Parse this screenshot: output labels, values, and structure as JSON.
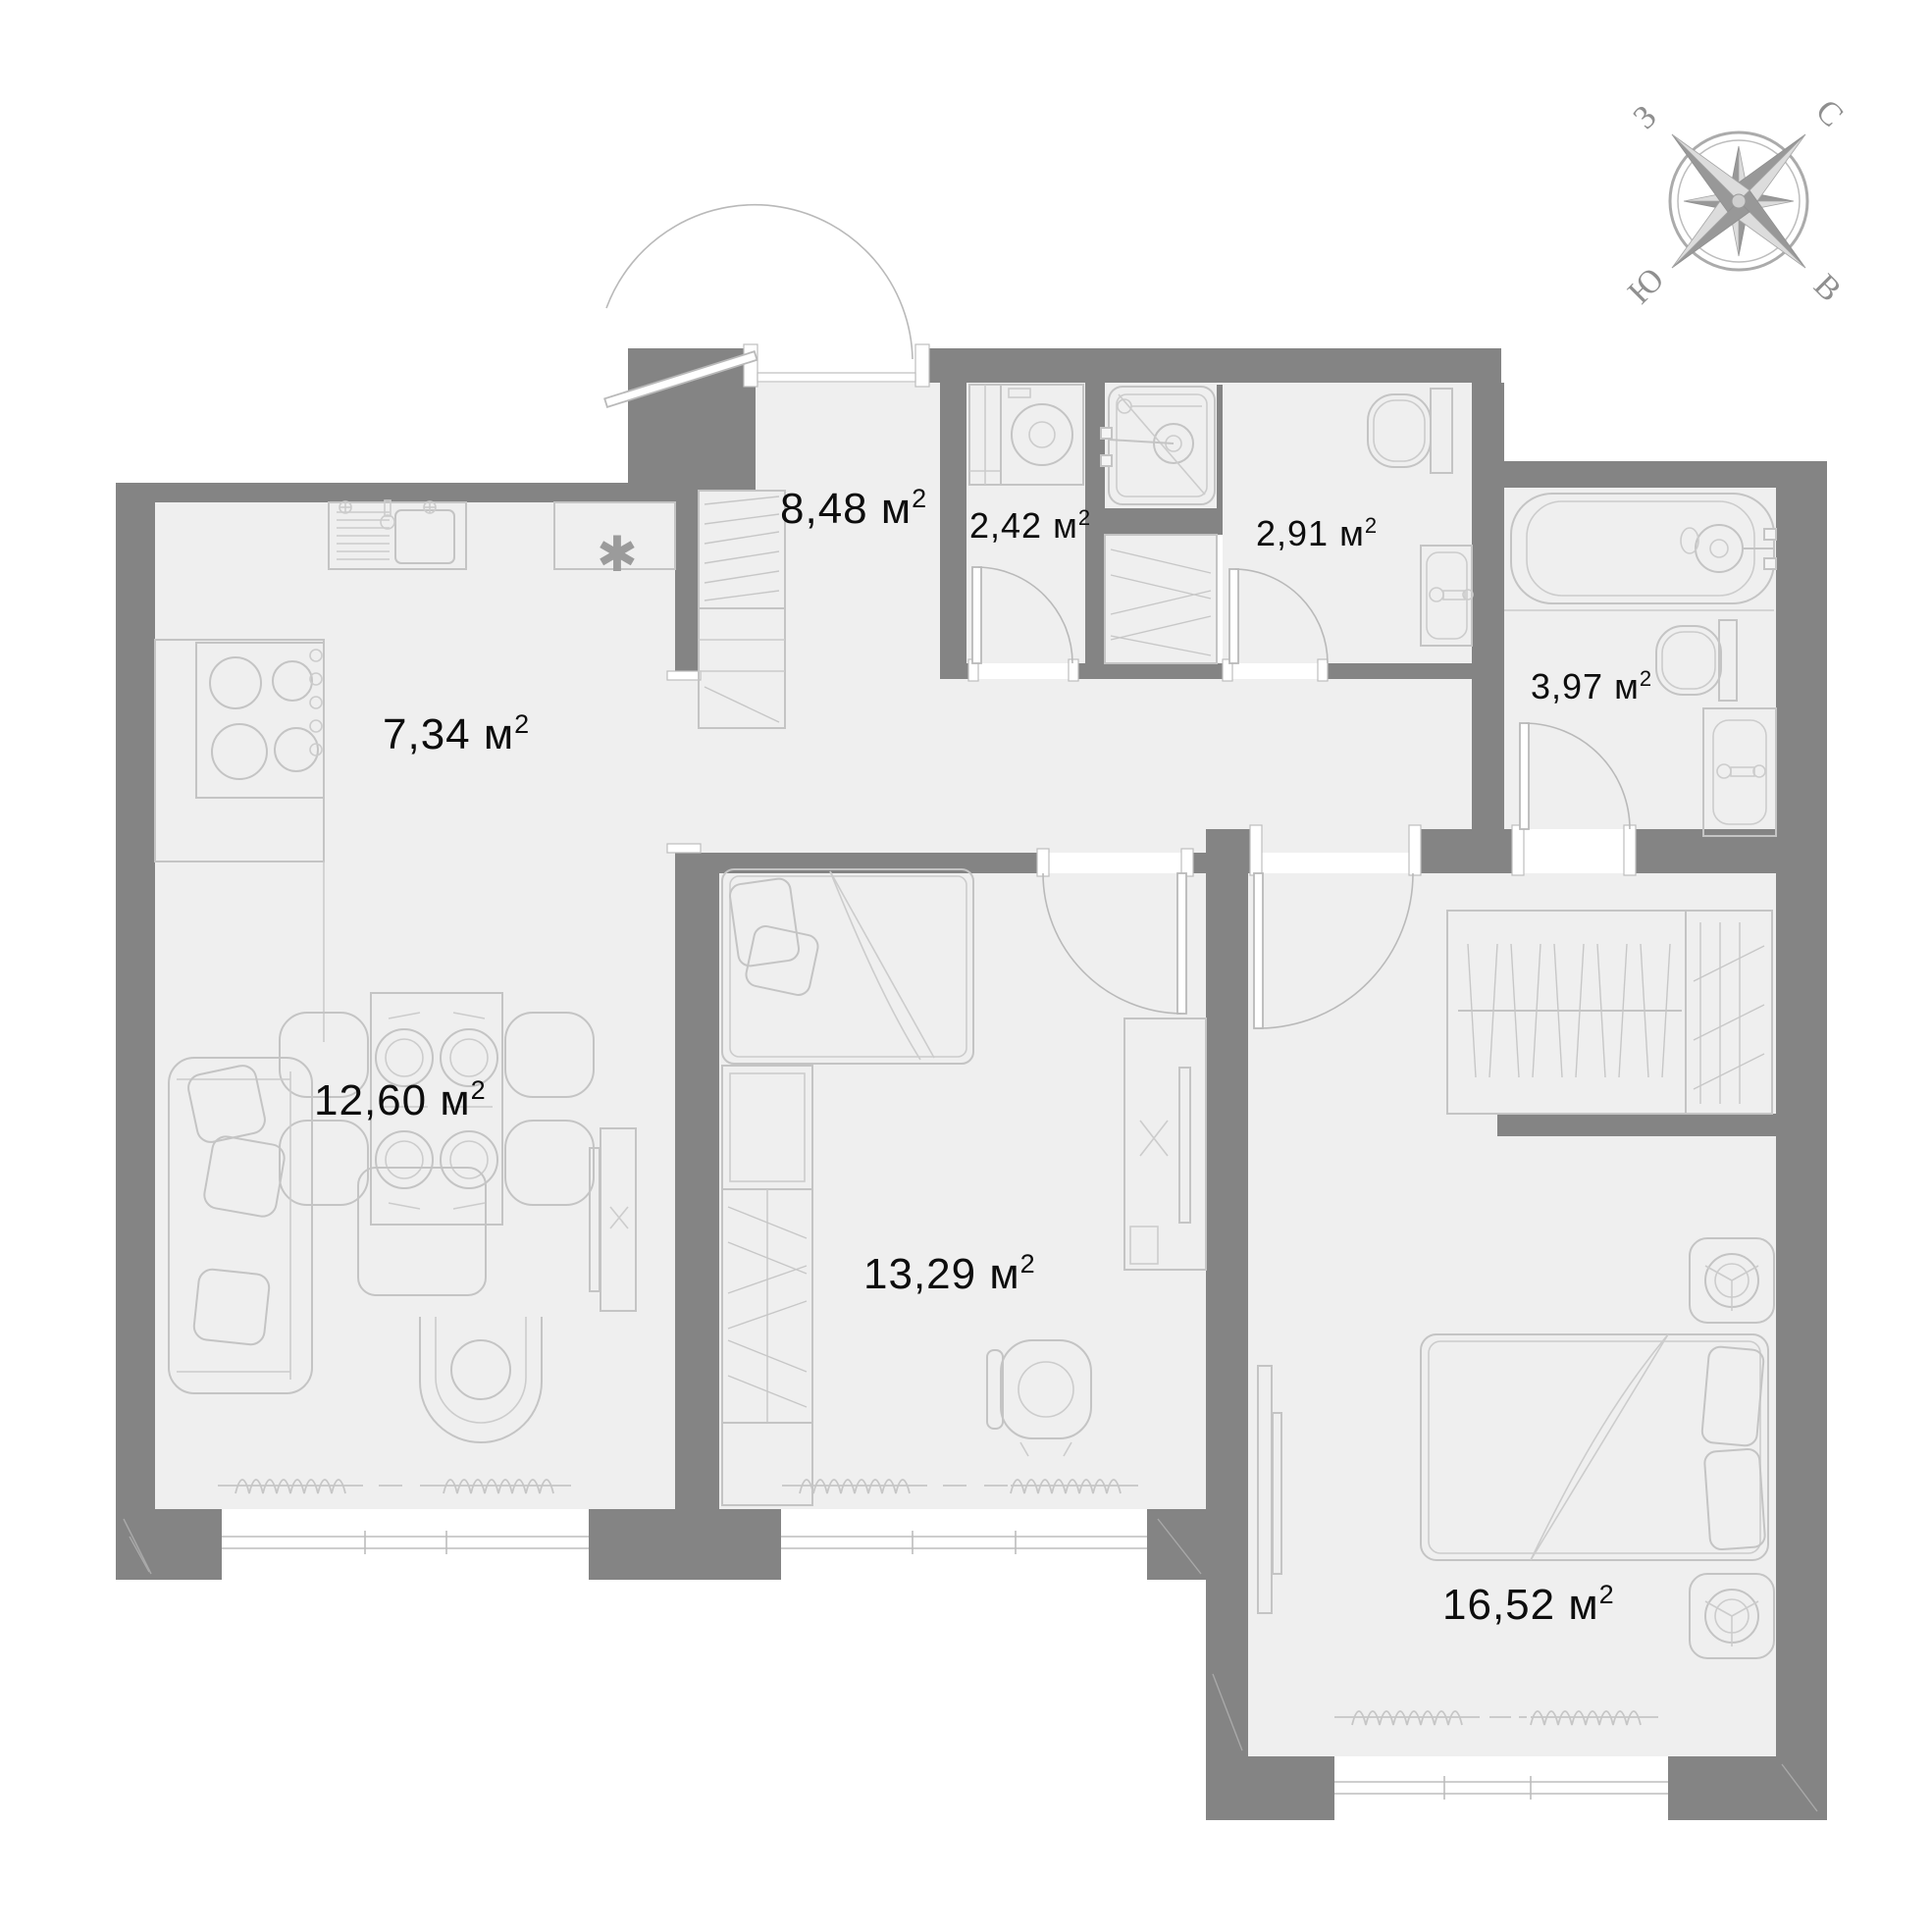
{
  "title": "apartment-floor-plan",
  "colors": {
    "wall": "#848484",
    "floor": "#efefef",
    "furniture_line": "#c4c4c4",
    "label": "#0d0d0d",
    "compass": "#8f8f8f"
  },
  "compass": {
    "north": "С",
    "south": "Ю",
    "west": "З",
    "east": "В"
  },
  "rooms": {
    "hallway": {
      "label": "8,48 м",
      "sup": "2"
    },
    "laundry": {
      "label": "2,42 м",
      "sup": "2"
    },
    "wc": {
      "label": "2,91 м",
      "sup": "2"
    },
    "bathroom": {
      "label": "3,97 м",
      "sup": "2"
    },
    "kitchen": {
      "label": "7,34 м",
      "sup": "2"
    },
    "living": {
      "label": "12,60 м",
      "sup": "2"
    },
    "bedroom": {
      "label": "13,29 м",
      "sup": "2"
    },
    "master": {
      "label": "16,52 м",
      "sup": "2"
    }
  },
  "symbols": {
    "kitchen_marker": "✱"
  }
}
